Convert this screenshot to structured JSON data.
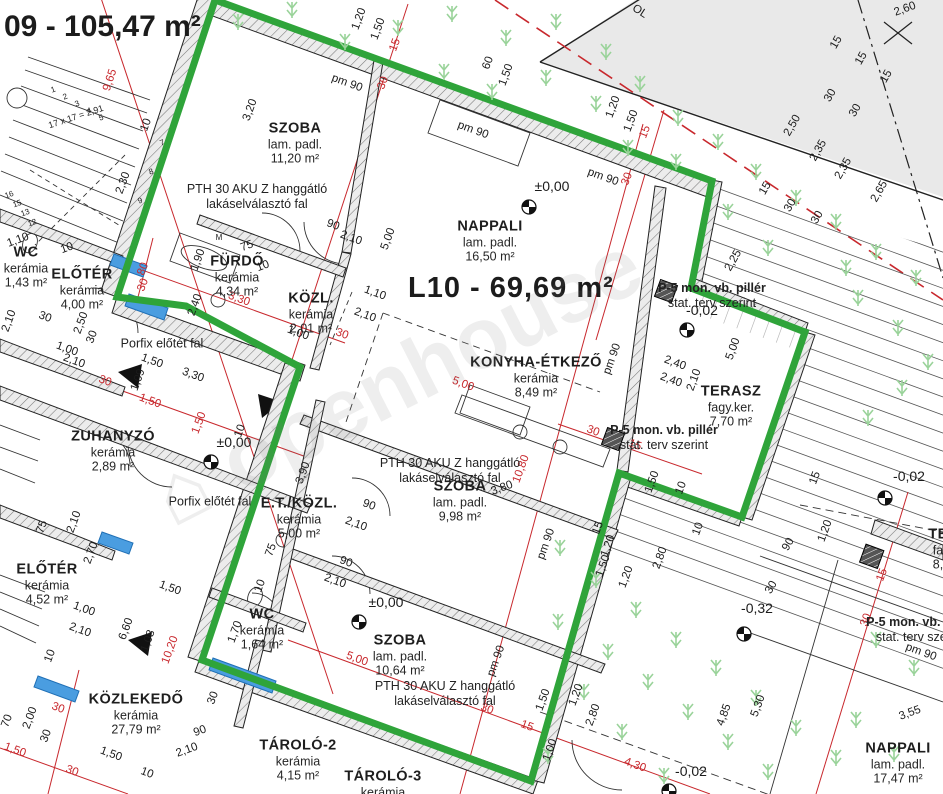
{
  "drawing": {
    "title_partial": "09 - 105,47 m²",
    "unit_label": "L10 - 69,69 m²",
    "watermark_text": "⌂ openhouse",
    "colors": {
      "boundary_green": "#2fa43a",
      "dimension_red": "#c8282d",
      "window_blue": "#4a9de0",
      "grass_green": "#9ad39a",
      "outside_gray": "#e9e9e9"
    },
    "rooms": [
      {
        "id": "szoba-1",
        "name": "SZOBA",
        "floor": "lam. padl.",
        "area": "11,20 m²",
        "x": 295,
        "y": 143
      },
      {
        "id": "nappali",
        "name": "NAPPALI",
        "floor": "lam. padl.",
        "area": "16,50 m²",
        "x": 490,
        "y": 241
      },
      {
        "id": "konyha-etkezo",
        "name": "KONYHA-ÉTKEZŐ",
        "floor": "kerámia",
        "area": "8,49 m²",
        "x": 536,
        "y": 377
      },
      {
        "id": "szoba-2",
        "name": "SZOBA",
        "floor": "lam. padl.",
        "area": "9,98 m²",
        "x": 460,
        "y": 501
      },
      {
        "id": "szoba-3",
        "name": "SZOBA",
        "floor": "lam. padl.",
        "area": "10,64 m²",
        "x": 400,
        "y": 655
      },
      {
        "id": "terasz",
        "name": "TERASZ",
        "floor": "fagy.ker.",
        "area": "7,70 m²",
        "x": 731,
        "y": 406
      },
      {
        "id": "wc-1",
        "name": "WC",
        "floor": "kerámia",
        "area": "1,43 m²",
        "x": 26,
        "y": 267
      },
      {
        "id": "eloter-1",
        "name": "ELŐTÉR",
        "floor": "kerámia",
        "area": "4,00 m²",
        "x": 82,
        "y": 289
      },
      {
        "id": "furdo",
        "name": "FÜRDŐ",
        "floor": "kerámia",
        "area": "4,34 m²",
        "x": 237,
        "y": 276
      },
      {
        "id": "kozl",
        "name": "KÖZL.",
        "floor": "kerámia",
        "area": "2,01 m²",
        "x": 311,
        "y": 313
      },
      {
        "id": "zuhanyzo",
        "name": "ZUHANYZÓ",
        "floor": "kerámia",
        "area": "2,89 m²",
        "x": 113,
        "y": 451
      },
      {
        "id": "et-kozl",
        "name": "E.T./KÖZL.",
        "floor": "kerámia",
        "area": "5,00 m²",
        "x": 299,
        "y": 518
      },
      {
        "id": "wc-2",
        "name": "WC",
        "floor": "kerámia",
        "area": "1,64 m²",
        "x": 262,
        "y": 629
      },
      {
        "id": "eloter-2",
        "name": "ELŐTÉR",
        "floor": "kerámia",
        "area": "4,52 m²",
        "x": 47,
        "y": 584
      },
      {
        "id": "kozlekedo",
        "name": "KÖZLEKEDŐ",
        "floor": "kerámia",
        "area": "27,79 m²",
        "x": 136,
        "y": 714
      },
      {
        "id": "tarolo-2",
        "name": "TÁROLÓ-2",
        "floor": "kerámia",
        "area": "4,15 m²",
        "x": 298,
        "y": 760
      },
      {
        "id": "tarolo-3",
        "name": "TÁROLÓ-3",
        "floor": "kerámia",
        "area": "",
        "x": 383,
        "y": 784
      },
      {
        "id": "nappali-2",
        "name": "NAPPALI",
        "floor": "lam. padl.",
        "area": "17,47 m²",
        "x": 898,
        "y": 763
      },
      {
        "id": "terasz-2",
        "name": "TE",
        "floor": "fa",
        "area": "8,",
        "x": 938,
        "y": 549
      }
    ],
    "notes": [
      {
        "id": "pth-1",
        "lines": [
          "PTH 30 AKU Z hanggátló",
          "lakáselválasztó fal"
        ],
        "x": 257,
        "y": 197
      },
      {
        "id": "pth-2",
        "lines": [
          "PTH 30 AKU Z hanggátló",
          "lakáselválasztó fal"
        ],
        "x": 450,
        "y": 471
      },
      {
        "id": "pth-3",
        "lines": [
          "PTH 30 AKU Z hanggátló",
          "lakáselválasztó fal"
        ],
        "x": 445,
        "y": 694
      },
      {
        "id": "porfix-1",
        "lines": [
          "Porfix előtét fal"
        ],
        "x": 162,
        "y": 344
      },
      {
        "id": "porfix-2",
        "lines": [
          "Porfix előtét fal"
        ],
        "x": 210,
        "y": 502
      },
      {
        "id": "p5-1",
        "lines": [
          "P-5 mon. vb. pillér",
          "stat. terv szerint"
        ],
        "x": 712,
        "y": 296,
        "bold_first": true
      },
      {
        "id": "p5-2",
        "lines": [
          "P-5 mon. vb. pillér",
          "stat. terv szerint"
        ],
        "x": 664,
        "y": 438,
        "bold_first": true
      },
      {
        "id": "p5-3",
        "lines": [
          "P-5 mon. vb. pillér",
          "stat. terv szerint"
        ],
        "x": 920,
        "y": 630,
        "bold_first": true
      },
      {
        "id": "stair-note",
        "lines": [
          "17 x 17 = 2,91"
        ],
        "x": 76,
        "y": 117,
        "rot": -18,
        "size": 9
      }
    ],
    "levels": [
      {
        "text": "±0,00",
        "x": 552,
        "y": 191,
        "mx": 529,
        "my": 207
      },
      {
        "text": "±0,00",
        "x": 234,
        "y": 447,
        "mx": 211,
        "my": 462
      },
      {
        "text": "±0,00",
        "x": 386,
        "y": 607,
        "mx": 359,
        "my": 622
      },
      {
        "text": "-0,02",
        "x": 702,
        "y": 315,
        "mx": 687,
        "my": 330
      },
      {
        "text": "-0,02",
        "x": 909,
        "y": 481,
        "mx": 885,
        "my": 498
      },
      {
        "text": "-0,02",
        "x": 691,
        "y": 776,
        "mx": 669,
        "my": 791
      },
      {
        "text": "-0,32",
        "x": 757,
        "y": 613,
        "mx": 744,
        "my": 634
      }
    ],
    "dimensions": [
      {
        "t": "9,65",
        "x": 113,
        "y": 81,
        "r": -72,
        "c": "red"
      },
      {
        "t": "1,20",
        "x": 362,
        "y": 20,
        "r": -70
      },
      {
        "t": "1,50",
        "x": 381,
        "y": 30,
        "r": -70
      },
      {
        "t": "pm 90",
        "x": 346,
        "y": 86,
        "r": 20
      },
      {
        "t": "15",
        "x": 398,
        "y": 46,
        "r": -70,
        "c": "red"
      },
      {
        "t": "30",
        "x": 386,
        "y": 84,
        "r": -70,
        "c": "red"
      },
      {
        "t": "60",
        "x": 491,
        "y": 64,
        "r": -70
      },
      {
        "t": "1,50",
        "x": 509,
        "y": 76,
        "r": -70
      },
      {
        "t": "pm 90",
        "x": 472,
        "y": 133,
        "r": 20
      },
      {
        "t": "1,20",
        "x": 616,
        "y": 108,
        "r": -70
      },
      {
        "t": "1,50",
        "x": 634,
        "y": 122,
        "r": -70
      },
      {
        "t": "pm 90",
        "x": 602,
        "y": 180,
        "r": 20
      },
      {
        "t": "15",
        "x": 648,
        "y": 133,
        "r": -70,
        "c": "red"
      },
      {
        "t": "30",
        "x": 630,
        "y": 180,
        "r": -70,
        "c": "red"
      },
      {
        "t": "3,20",
        "x": 253,
        "y": 111,
        "r": -70
      },
      {
        "t": "2,30",
        "x": 126,
        "y": 184,
        "r": -70
      },
      {
        "t": "10",
        "x": 149,
        "y": 126,
        "r": -70
      },
      {
        "t": "2,60",
        "x": 906,
        "y": 12,
        "r": -20
      },
      {
        "t": "OL",
        "x": 638,
        "y": 14,
        "r": 33
      },
      {
        "t": "15",
        "x": 839,
        "y": 44,
        "r": -60
      },
      {
        "t": "15",
        "x": 864,
        "y": 60,
        "r": -60
      },
      {
        "t": "15",
        "x": 889,
        "y": 78,
        "r": -60
      },
      {
        "t": "30",
        "x": 833,
        "y": 97,
        "r": -60
      },
      {
        "t": "30",
        "x": 858,
        "y": 112,
        "r": -60
      },
      {
        "t": "2,50",
        "x": 795,
        "y": 127,
        "r": -60
      },
      {
        "t": "2,35",
        "x": 821,
        "y": 152,
        "r": -60
      },
      {
        "t": "2,35",
        "x": 846,
        "y": 170,
        "r": -60
      },
      {
        "t": "2,65",
        "x": 882,
        "y": 193,
        "r": -60
      },
      {
        "t": "15",
        "x": 768,
        "y": 190,
        "r": -60
      },
      {
        "t": "30",
        "x": 793,
        "y": 207,
        "r": -60
      },
      {
        "t": "30",
        "x": 820,
        "y": 219,
        "r": -60
      },
      {
        "t": "2,25",
        "x": 736,
        "y": 262,
        "r": -60
      },
      {
        "t": "5,00",
        "x": 736,
        "y": 350,
        "r": -70
      },
      {
        "t": "2,40",
        "x": 674,
        "y": 366,
        "r": 20
      },
      {
        "t": "2,40",
        "x": 670,
        "y": 383,
        "r": 20
      },
      {
        "t": "2,10",
        "x": 697,
        "y": 381,
        "r": -70
      },
      {
        "t": "1,50",
        "x": 655,
        "y": 483,
        "r": -70
      },
      {
        "t": "10",
        "x": 684,
        "y": 489,
        "r": -70
      },
      {
        "t": "10",
        "x": 701,
        "y": 530,
        "r": -70
      },
      {
        "t": "15",
        "x": 601,
        "y": 529,
        "r": -70
      },
      {
        "t": "1,20",
        "x": 611,
        "y": 547,
        "r": -70
      },
      {
        "t": "1,50",
        "x": 606,
        "y": 567,
        "r": -70
      },
      {
        "t": "1,20",
        "x": 629,
        "y": 578,
        "r": -70
      },
      {
        "t": "2,80",
        "x": 663,
        "y": 559,
        "r": -70
      },
      {
        "t": "30",
        "x": 592,
        "y": 434,
        "r": 20,
        "c": "red"
      },
      {
        "t": "15",
        "x": 634,
        "y": 448,
        "r": 20,
        "c": "red"
      },
      {
        "t": "10,80",
        "x": 524,
        "y": 470,
        "r": -70,
        "c": "red"
      },
      {
        "t": "pm 90",
        "x": 549,
        "y": 545,
        "r": -70
      },
      {
        "t": "3,80",
        "x": 503,
        "y": 491,
        "r": -20
      },
      {
        "t": "pm 90",
        "x": 615,
        "y": 360,
        "r": -70
      },
      {
        "t": "5,00",
        "x": 391,
        "y": 240,
        "r": -70
      },
      {
        "t": "5,00",
        "x": 462,
        "y": 387,
        "r": 20,
        "c": "red"
      },
      {
        "t": "90",
        "x": 332,
        "y": 228,
        "r": 20
      },
      {
        "t": "2,10",
        "x": 350,
        "y": 241,
        "r": 20
      },
      {
        "t": "1,10",
        "x": 374,
        "y": 296,
        "r": 20
      },
      {
        "t": "2,10",
        "x": 364,
        "y": 318,
        "r": 20
      },
      {
        "t": "30",
        "x": 341,
        "y": 337,
        "r": 20,
        "c": "red"
      },
      {
        "t": "90",
        "x": 368,
        "y": 508,
        "r": 20
      },
      {
        "t": "2,10",
        "x": 355,
        "y": 527,
        "r": 20
      },
      {
        "t": "90",
        "x": 345,
        "y": 565,
        "r": 20
      },
      {
        "t": "2,10",
        "x": 334,
        "y": 584,
        "r": 20
      },
      {
        "t": "3,90",
        "x": 306,
        "y": 474,
        "r": -70
      },
      {
        "t": "75",
        "x": 274,
        "y": 551,
        "r": -70
      },
      {
        "t": "10",
        "x": 263,
        "y": 587,
        "r": -70
      },
      {
        "t": "1,70",
        "x": 238,
        "y": 633,
        "r": -70
      },
      {
        "t": "pm 90",
        "x": 499,
        "y": 662,
        "r": -70
      },
      {
        "t": "5,00",
        "x": 356,
        "y": 662,
        "r": 20,
        "c": "red"
      },
      {
        "t": "30",
        "x": 486,
        "y": 712,
        "r": 20,
        "c": "red"
      },
      {
        "t": "15",
        "x": 526,
        "y": 729,
        "r": 20,
        "c": "red"
      },
      {
        "t": "4,30",
        "x": 634,
        "y": 768,
        "r": 20,
        "c": "red"
      },
      {
        "t": "1,50",
        "x": 546,
        "y": 701,
        "r": -70
      },
      {
        "t": "1,20",
        "x": 579,
        "y": 696,
        "r": -70
      },
      {
        "t": "2,80",
        "x": 596,
        "y": 716,
        "r": -70
      },
      {
        "t": "1,00",
        "x": 553,
        "y": 751,
        "r": -70
      },
      {
        "t": "90",
        "x": 791,
        "y": 546,
        "r": -60
      },
      {
        "t": "30",
        "x": 774,
        "y": 589,
        "r": -60
      },
      {
        "t": "1,20",
        "x": 828,
        "y": 532,
        "r": -70
      },
      {
        "t": "15",
        "x": 818,
        "y": 479,
        "r": -70
      },
      {
        "t": "4,85",
        "x": 727,
        "y": 716,
        "r": -70
      },
      {
        "t": "5,30",
        "x": 761,
        "y": 707,
        "r": -70
      },
      {
        "t": "3,55",
        "x": 911,
        "y": 716,
        "r": -20
      },
      {
        "t": "pm 90",
        "x": 920,
        "y": 655,
        "r": 20
      },
      {
        "t": "15",
        "x": 885,
        "y": 576,
        "r": -70,
        "c": "red"
      },
      {
        "t": "30",
        "x": 869,
        "y": 621,
        "r": -70,
        "c": "red"
      },
      {
        "t": "1,10",
        "x": 19,
        "y": 243,
        "r": -20
      },
      {
        "t": "10",
        "x": 68,
        "y": 251,
        "r": -20
      },
      {
        "t": "80",
        "x": 146,
        "y": 270,
        "r": -70,
        "c": "red"
      },
      {
        "t": "30",
        "x": 146,
        "y": 286,
        "r": -70,
        "c": "red"
      },
      {
        "t": "1,90",
        "x": 201,
        "y": 261,
        "r": -70
      },
      {
        "t": "75",
        "x": 248,
        "y": 249,
        "r": -20
      },
      {
        "t": "10",
        "x": 264,
        "y": 269,
        "r": -20
      },
      {
        "t": "2,40",
        "x": 198,
        "y": 306,
        "r": -70
      },
      {
        "t": "3,30",
        "x": 238,
        "y": 302,
        "r": 20,
        "c": "red"
      },
      {
        "t": "1,00",
        "x": 297,
        "y": 336,
        "r": 20
      },
      {
        "t": "2,50",
        "x": 84,
        "y": 324,
        "r": -70
      },
      {
        "t": "30",
        "x": 95,
        "y": 338,
        "r": -70
      },
      {
        "t": "1,00",
        "x": 66,
        "y": 352,
        "r": 20
      },
      {
        "t": "2,10",
        "x": 73,
        "y": 364,
        "r": 20
      },
      {
        "t": "30",
        "x": 44,
        "y": 320,
        "r": 20
      },
      {
        "t": "2,10",
        "x": 12,
        "y": 322,
        "r": -70
      },
      {
        "t": "3,30",
        "x": 192,
        "y": 378,
        "r": 20
      },
      {
        "t": "1,50",
        "x": 151,
        "y": 364,
        "r": 20
      },
      {
        "t": "1,09",
        "x": 141,
        "y": 381,
        "r": -70
      },
      {
        "t": "30",
        "x": 104,
        "y": 384,
        "r": 20,
        "c": "red"
      },
      {
        "t": "1,50",
        "x": 149,
        "y": 404,
        "r": 20,
        "c": "red"
      },
      {
        "t": "1,50",
        "x": 202,
        "y": 424,
        "r": -70,
        "c": "red"
      },
      {
        "t": "10",
        "x": 243,
        "y": 432,
        "r": -70
      },
      {
        "t": "70",
        "x": 10,
        "y": 722,
        "r": -70
      },
      {
        "t": "2,00",
        "x": 33,
        "y": 719,
        "r": -70
      },
      {
        "t": "30",
        "x": 49,
        "y": 737,
        "r": -70
      },
      {
        "t": "30",
        "x": 57,
        "y": 711,
        "r": 20,
        "c": "red"
      },
      {
        "t": "1,50",
        "x": 14,
        "y": 753,
        "r": 20,
        "c": "red"
      },
      {
        "t": "30",
        "x": 71,
        "y": 774,
        "r": 20,
        "c": "red"
      },
      {
        "t": "1,50",
        "x": 110,
        "y": 757,
        "r": 20
      },
      {
        "t": "10",
        "x": 146,
        "y": 776,
        "r": 20
      },
      {
        "t": "90",
        "x": 201,
        "y": 734,
        "r": -20
      },
      {
        "t": "2,10",
        "x": 188,
        "y": 753,
        "r": -20
      },
      {
        "t": "30",
        "x": 216,
        "y": 699,
        "r": -70
      },
      {
        "t": "6,60",
        "x": 129,
        "y": 630,
        "r": -70
      },
      {
        "t": "10,20",
        "x": 173,
        "y": 651,
        "r": -70,
        "c": "red"
      },
      {
        "t": "2,70",
        "x": 94,
        "y": 554,
        "r": -70
      },
      {
        "t": "1,50",
        "x": 169,
        "y": 591,
        "r": 20
      },
      {
        "t": "1,00",
        "x": 83,
        "y": 612,
        "r": 20
      },
      {
        "t": "2,10",
        "x": 79,
        "y": 633,
        "r": 20
      },
      {
        "t": "10",
        "x": 53,
        "y": 657,
        "r": -70
      },
      {
        "t": "1,08",
        "x": 151,
        "y": 642,
        "r": -70
      },
      {
        "t": "2,10",
        "x": 77,
        "y": 523,
        "r": -70
      },
      {
        "t": "75",
        "x": 45,
        "y": 528,
        "r": -70
      },
      {
        "t": "M",
        "x": 219,
        "y": 240,
        "r": 0,
        "s": 8
      },
      {
        "t": "1",
        "x": 54,
        "y": 92,
        "r": -20,
        "s": 8
      },
      {
        "t": "2",
        "x": 66,
        "y": 99,
        "r": -20,
        "s": 8
      },
      {
        "t": "3",
        "x": 78,
        "y": 106,
        "r": -20,
        "s": 8
      },
      {
        "t": "4",
        "x": 90,
        "y": 113,
        "r": -20,
        "s": 8
      },
      {
        "t": "5",
        "x": 102,
        "y": 120,
        "r": -20,
        "s": 8
      },
      {
        "t": "7",
        "x": 163,
        "y": 145,
        "r": -20,
        "s": 8
      },
      {
        "t": "8",
        "x": 152,
        "y": 174,
        "r": -20,
        "s": 8
      },
      {
        "t": "9",
        "x": 141,
        "y": 203,
        "r": -20,
        "s": 8
      },
      {
        "t": "16",
        "x": 10,
        "y": 197,
        "r": -20,
        "s": 8
      },
      {
        "t": "15",
        "x": 18,
        "y": 206,
        "r": -20,
        "s": 8
      },
      {
        "t": "13",
        "x": 26,
        "y": 215,
        "r": -20,
        "s": 8
      },
      {
        "t": "12",
        "x": 33,
        "y": 225,
        "r": -20,
        "s": 8
      }
    ]
  }
}
